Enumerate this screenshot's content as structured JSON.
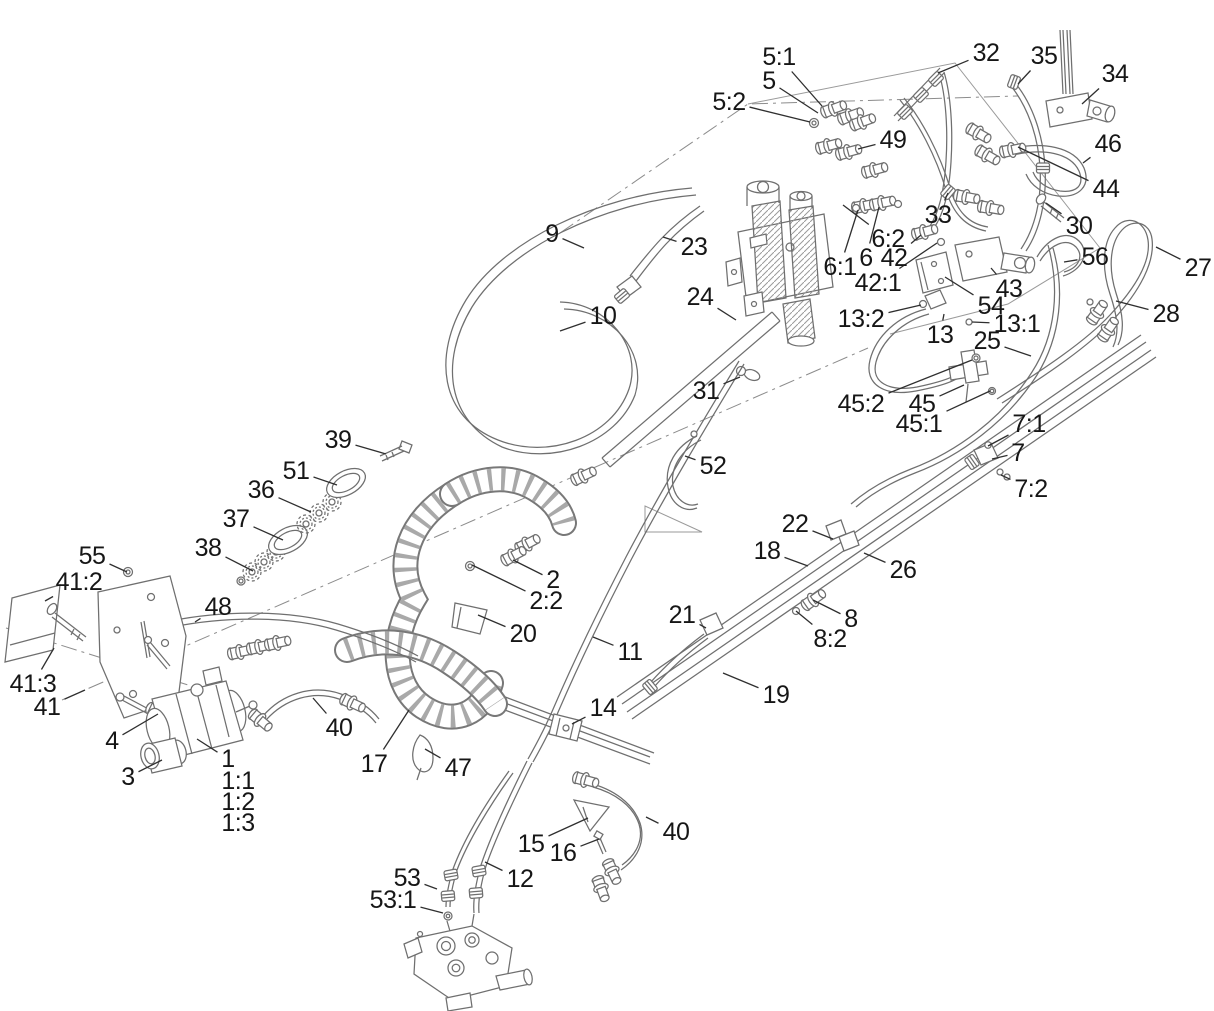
{
  "meta": {
    "type": "exploded-parts-diagram",
    "subject": "Hydraulic hose, valve and fitting assembly",
    "background": "#ffffff"
  },
  "colors": {
    "artwork_line": "#6f6f6f",
    "leader_line": "#2f2f2f",
    "label_text": "#161616"
  },
  "callouts": [
    {
      "label": "5:1",
      "x": 779,
      "y": 57,
      "tx": 822,
      "ty": 106
    },
    {
      "label": "5",
      "x": 769,
      "y": 81,
      "tx": 818,
      "ty": 113
    },
    {
      "label": "5:2",
      "x": 729,
      "y": 102,
      "tx": 810,
      "ty": 122
    },
    {
      "label": "32",
      "x": 986,
      "y": 53,
      "tx": 938,
      "ty": 73
    },
    {
      "label": "35",
      "x": 1044,
      "y": 56,
      "tx": 1018,
      "ty": 84
    },
    {
      "label": "34",
      "x": 1115,
      "y": 74,
      "tx": 1082,
      "ty": 104
    },
    {
      "label": "49",
      "x": 893,
      "y": 140,
      "tx": 858,
      "ty": 149
    },
    {
      "label": "46",
      "x": 1108,
      "y": 144,
      "tx": 1083,
      "ty": 163
    },
    {
      "label": "44",
      "x": 1106,
      "y": 189,
      "tx": 1018,
      "ty": 147
    },
    {
      "label": "33",
      "x": 938,
      "y": 215,
      "tx": 948,
      "ty": 193
    },
    {
      "label": "30",
      "x": 1079,
      "y": 226,
      "tx": 1046,
      "ty": 203
    },
    {
      "label": "56",
      "x": 1095,
      "y": 257,
      "tx": 1064,
      "ty": 262
    },
    {
      "label": "27",
      "x": 1198,
      "y": 268,
      "tx": 1156,
      "ty": 247
    },
    {
      "label": "9",
      "x": 552,
      "y": 234,
      "tx": 584,
      "ty": 248
    },
    {
      "label": "23",
      "x": 694,
      "y": 247,
      "tx": 663,
      "ty": 237
    },
    {
      "label": "6:1",
      "x": 840,
      "y": 267,
      "tx": 858,
      "ty": 210
    },
    {
      "label": "6",
      "x": 866,
      "y": 258,
      "tx": 879,
      "ty": 207
    },
    {
      "label": "6:2",
      "x": 888,
      "y": 239,
      "tx": 843,
      "ty": 205
    },
    {
      "label": "42",
      "x": 894,
      "y": 258,
      "tx": 921,
      "ty": 235
    },
    {
      "label": "42:1",
      "x": 878,
      "y": 283,
      "tx": 937,
      "ty": 243
    },
    {
      "label": "43",
      "x": 1009,
      "y": 289,
      "tx": 991,
      "ty": 268
    },
    {
      "label": "54",
      "x": 991,
      "y": 306,
      "tx": 945,
      "ty": 277
    },
    {
      "label": "13:2",
      "x": 861,
      "y": 319,
      "tx": 921,
      "ty": 305
    },
    {
      "label": "13",
      "x": 940,
      "y": 335,
      "tx": 944,
      "ty": 314
    },
    {
      "label": "13:1",
      "x": 1017,
      "y": 324,
      "tx": 972,
      "ty": 322
    },
    {
      "label": "25",
      "x": 987,
      "y": 341,
      "tx": 1031,
      "ty": 356
    },
    {
      "label": "10",
      "x": 603,
      "y": 316,
      "tx": 560,
      "ty": 331
    },
    {
      "label": "24",
      "x": 700,
      "y": 297,
      "tx": 736,
      "ty": 320
    },
    {
      "label": "31",
      "x": 706,
      "y": 391,
      "tx": 740,
      "ty": 377
    },
    {
      "label": "45:2",
      "x": 861,
      "y": 404,
      "tx": 972,
      "ty": 360
    },
    {
      "label": "45",
      "x": 922,
      "y": 404,
      "tx": 964,
      "ty": 385
    },
    {
      "label": "45:1",
      "x": 919,
      "y": 424,
      "tx": 990,
      "ty": 391
    },
    {
      "label": "7:1",
      "x": 1029,
      "y": 424,
      "tx": 988,
      "ty": 446
    },
    {
      "label": "7",
      "x": 1018,
      "y": 453,
      "tx": 992,
      "ty": 459
    },
    {
      "label": "7:2",
      "x": 1031,
      "y": 489,
      "tx": 1001,
      "ty": 475
    },
    {
      "label": "28",
      "x": 1166,
      "y": 314,
      "tx": 1116,
      "ty": 301
    },
    {
      "label": "39",
      "x": 338,
      "y": 440,
      "tx": 386,
      "ty": 454
    },
    {
      "label": "51",
      "x": 296,
      "y": 471,
      "tx": 337,
      "ty": 485
    },
    {
      "label": "36",
      "x": 261,
      "y": 490,
      "tx": 311,
      "ty": 512
    },
    {
      "label": "37",
      "x": 236,
      "y": 519,
      "tx": 283,
      "ty": 540
    },
    {
      "label": "38",
      "x": 208,
      "y": 548,
      "tx": 253,
      "ty": 571
    },
    {
      "label": "52",
      "x": 713,
      "y": 466,
      "tx": 685,
      "ty": 456
    },
    {
      "label": "55",
      "x": 92,
      "y": 556,
      "tx": 127,
      "ty": 572
    },
    {
      "label": "41:2",
      "x": 79,
      "y": 582,
      "tx": 45,
      "ty": 601
    },
    {
      "label": "48",
      "x": 218,
      "y": 607,
      "tx": 195,
      "ty": 622
    },
    {
      "label": "2",
      "x": 553,
      "y": 580,
      "tx": 513,
      "ty": 560
    },
    {
      "label": "2:2",
      "x": 546,
      "y": 601,
      "tx": 472,
      "ty": 565
    },
    {
      "label": "20",
      "x": 523,
      "y": 634,
      "tx": 478,
      "ty": 615
    },
    {
      "label": "22",
      "x": 795,
      "y": 524,
      "tx": 833,
      "ty": 539
    },
    {
      "label": "18",
      "x": 767,
      "y": 551,
      "tx": 808,
      "ty": 566
    },
    {
      "label": "26",
      "x": 903,
      "y": 570,
      "tx": 864,
      "ty": 553
    },
    {
      "label": "21",
      "x": 682,
      "y": 615,
      "tx": 706,
      "ty": 628
    },
    {
      "label": "8",
      "x": 851,
      "y": 619,
      "tx": 813,
      "ty": 600
    },
    {
      "label": "8:2",
      "x": 830,
      "y": 639,
      "tx": 796,
      "ty": 611
    },
    {
      "label": "11",
      "x": 630,
      "y": 652,
      "tx": 593,
      "ty": 637
    },
    {
      "label": "19",
      "x": 776,
      "y": 695,
      "tx": 723,
      "ty": 673
    },
    {
      "label": "41:3",
      "x": 33,
      "y": 684,
      "tx": 54,
      "ty": 648
    },
    {
      "label": "41",
      "x": 47,
      "y": 707,
      "tx": 85,
      "ty": 690
    },
    {
      "label": "4",
      "x": 112,
      "y": 741,
      "tx": 158,
      "ty": 714
    },
    {
      "label": "40",
      "x": 339,
      "y": 728,
      "tx": 313,
      "ty": 698
    },
    {
      "label": "17",
      "x": 374,
      "y": 764,
      "tx": 409,
      "ty": 710
    },
    {
      "label": "47",
      "x": 458,
      "y": 768,
      "tx": 425,
      "ty": 749
    },
    {
      "label": "14",
      "x": 603,
      "y": 708,
      "tx": 572,
      "ty": 724
    },
    {
      "label": "3",
      "x": 128,
      "y": 777,
      "tx": 162,
      "ty": 760
    },
    {
      "label": "1",
      "x": 228,
      "y": 759,
      "tx": 197,
      "ty": 739
    },
    {
      "label": "1:1",
      "x": 238,
      "y": 781
    },
    {
      "label": "1:2",
      "x": 238,
      "y": 802
    },
    {
      "label": "1:3",
      "x": 238,
      "y": 823
    },
    {
      "label": "15",
      "x": 531,
      "y": 844,
      "tx": 588,
      "ty": 818
    },
    {
      "label": "16",
      "x": 563,
      "y": 853,
      "tx": 599,
      "ty": 839
    },
    {
      "label": "40",
      "x": 676,
      "y": 832,
      "tx": 646,
      "ty": 817
    },
    {
      "label": "53",
      "x": 407,
      "y": 878,
      "tx": 437,
      "ty": 889
    },
    {
      "label": "53:1",
      "x": 393,
      "y": 900,
      "tx": 443,
      "ty": 913
    },
    {
      "label": "12",
      "x": 520,
      "y": 879,
      "tx": 485,
      "ty": 862
    }
  ]
}
